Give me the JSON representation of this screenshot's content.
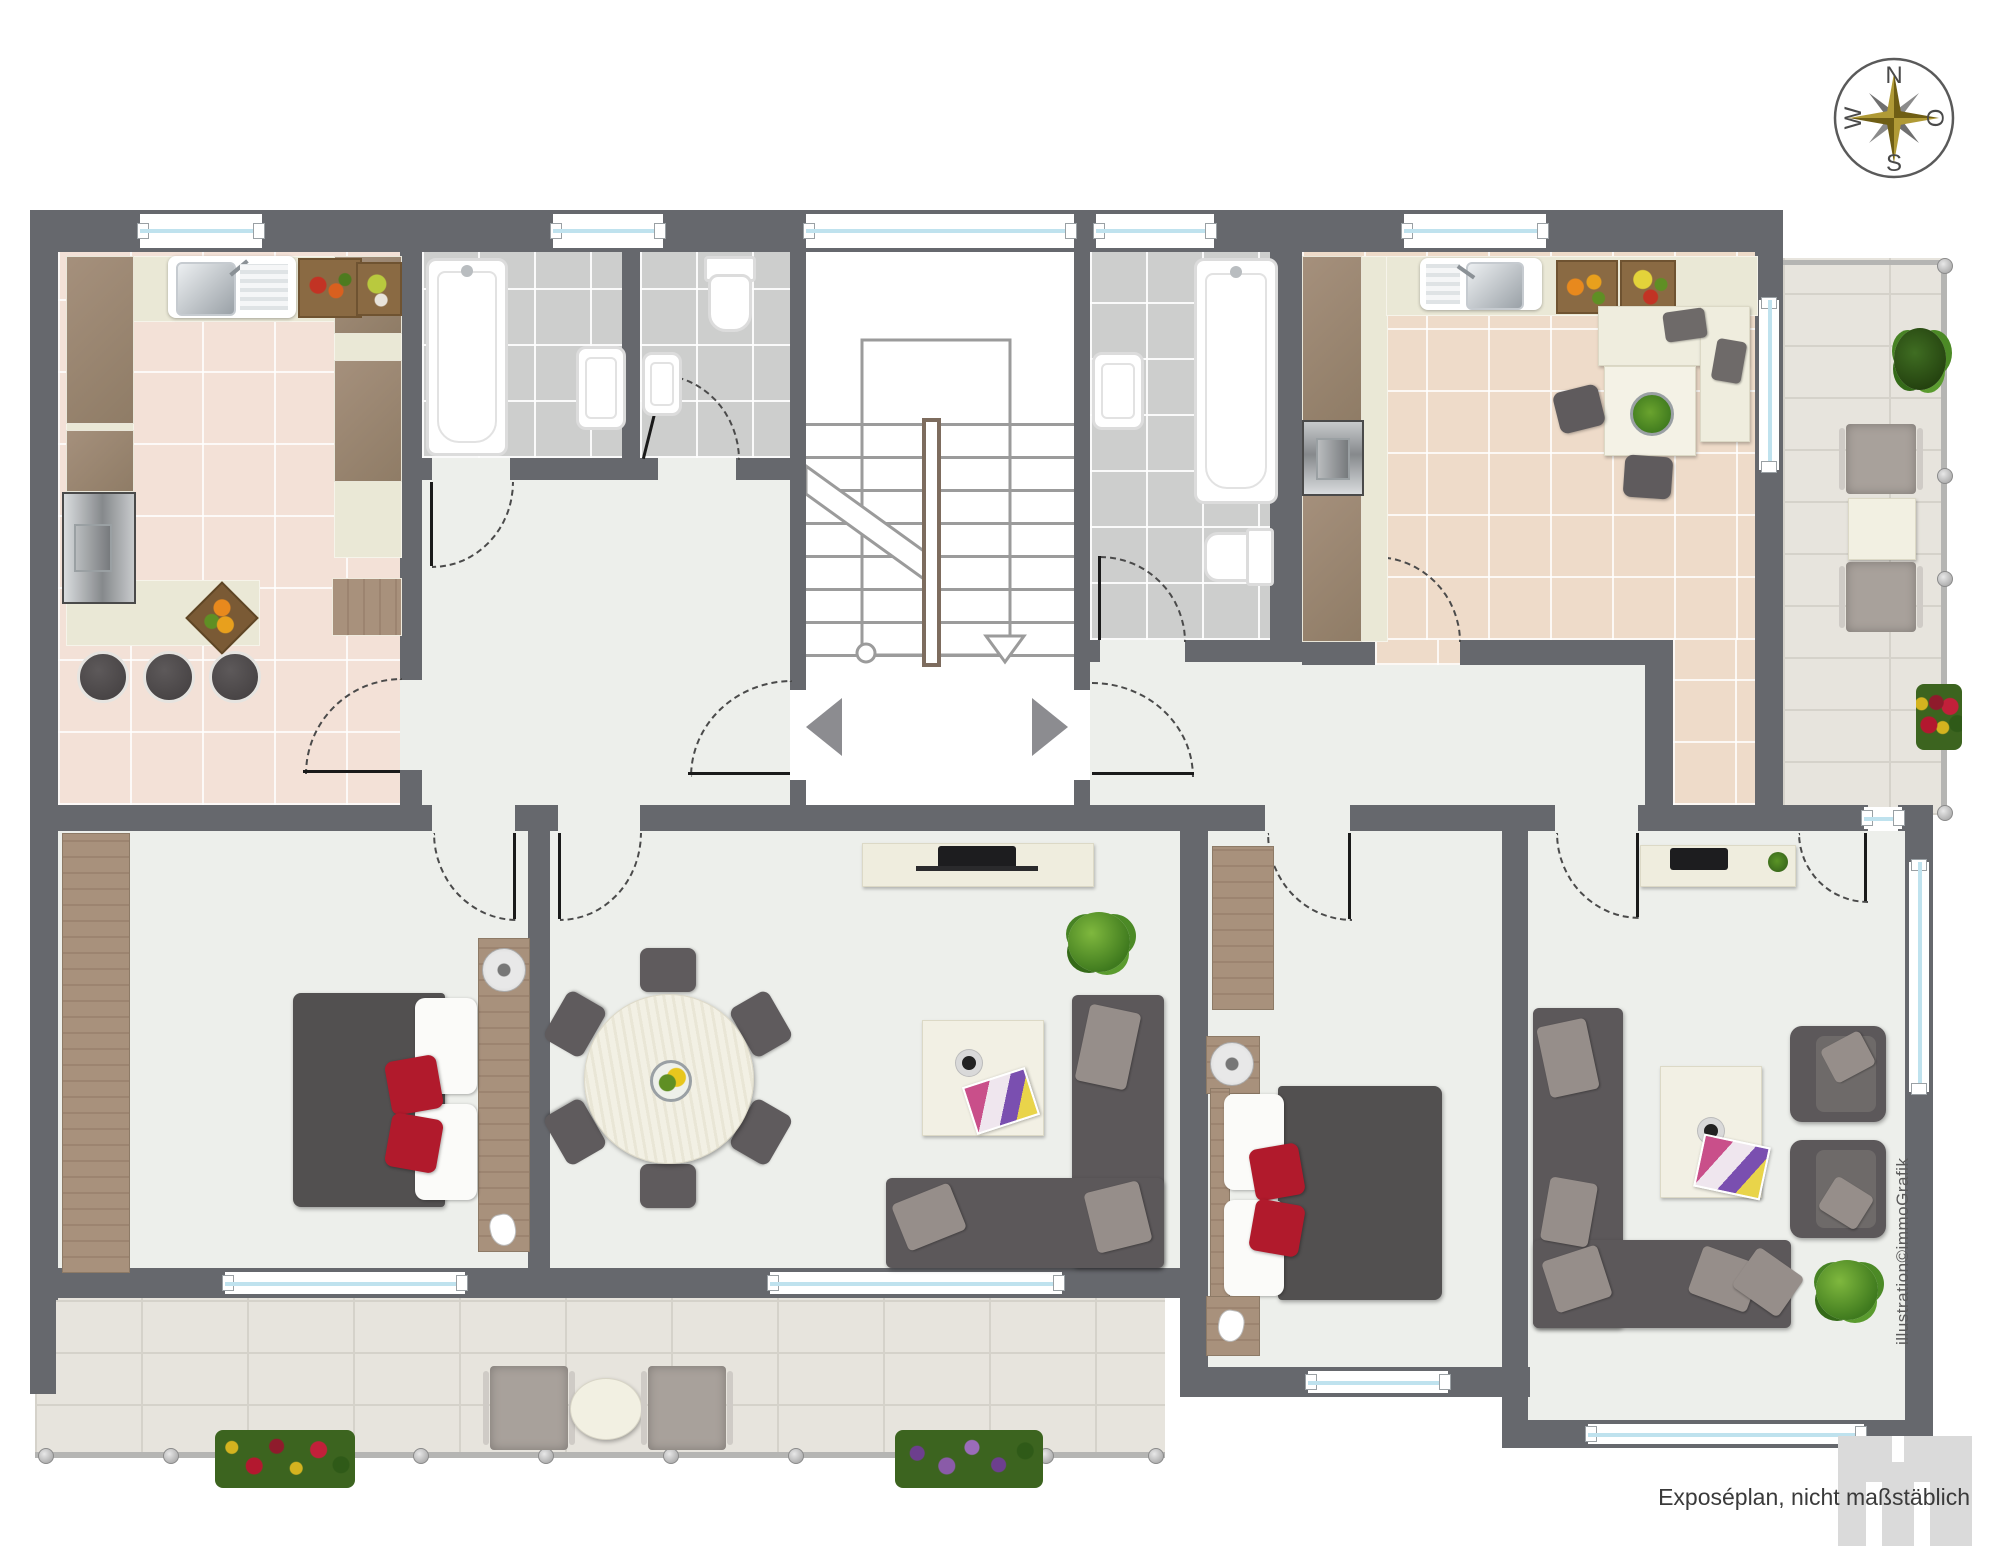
{
  "compass": {
    "north": "N",
    "east": "O",
    "south": "S",
    "west": "W"
  },
  "footer": {
    "note": "Exposéplan, nicht maßstäblich"
  },
  "watermark": {
    "credit": "illustration©immoGrafik"
  },
  "palette": {
    "wall": "#66686d",
    "floor_light": "#edefeb",
    "kitchen_tile": "#f3e1d7",
    "bath_tile": "#cdcecd",
    "beige_tile": "#eedbc9",
    "paving": "#e7e4dd",
    "sofa_gray": "#5c585a",
    "bed_gray": "#525050",
    "accent_red": "#b11a2c",
    "wood": "#a8917c",
    "ivory": "#efedde",
    "window_glass": "#bfe2ee",
    "compass_gold": "#8f7a1e",
    "logo_gray": "#dadada"
  }
}
